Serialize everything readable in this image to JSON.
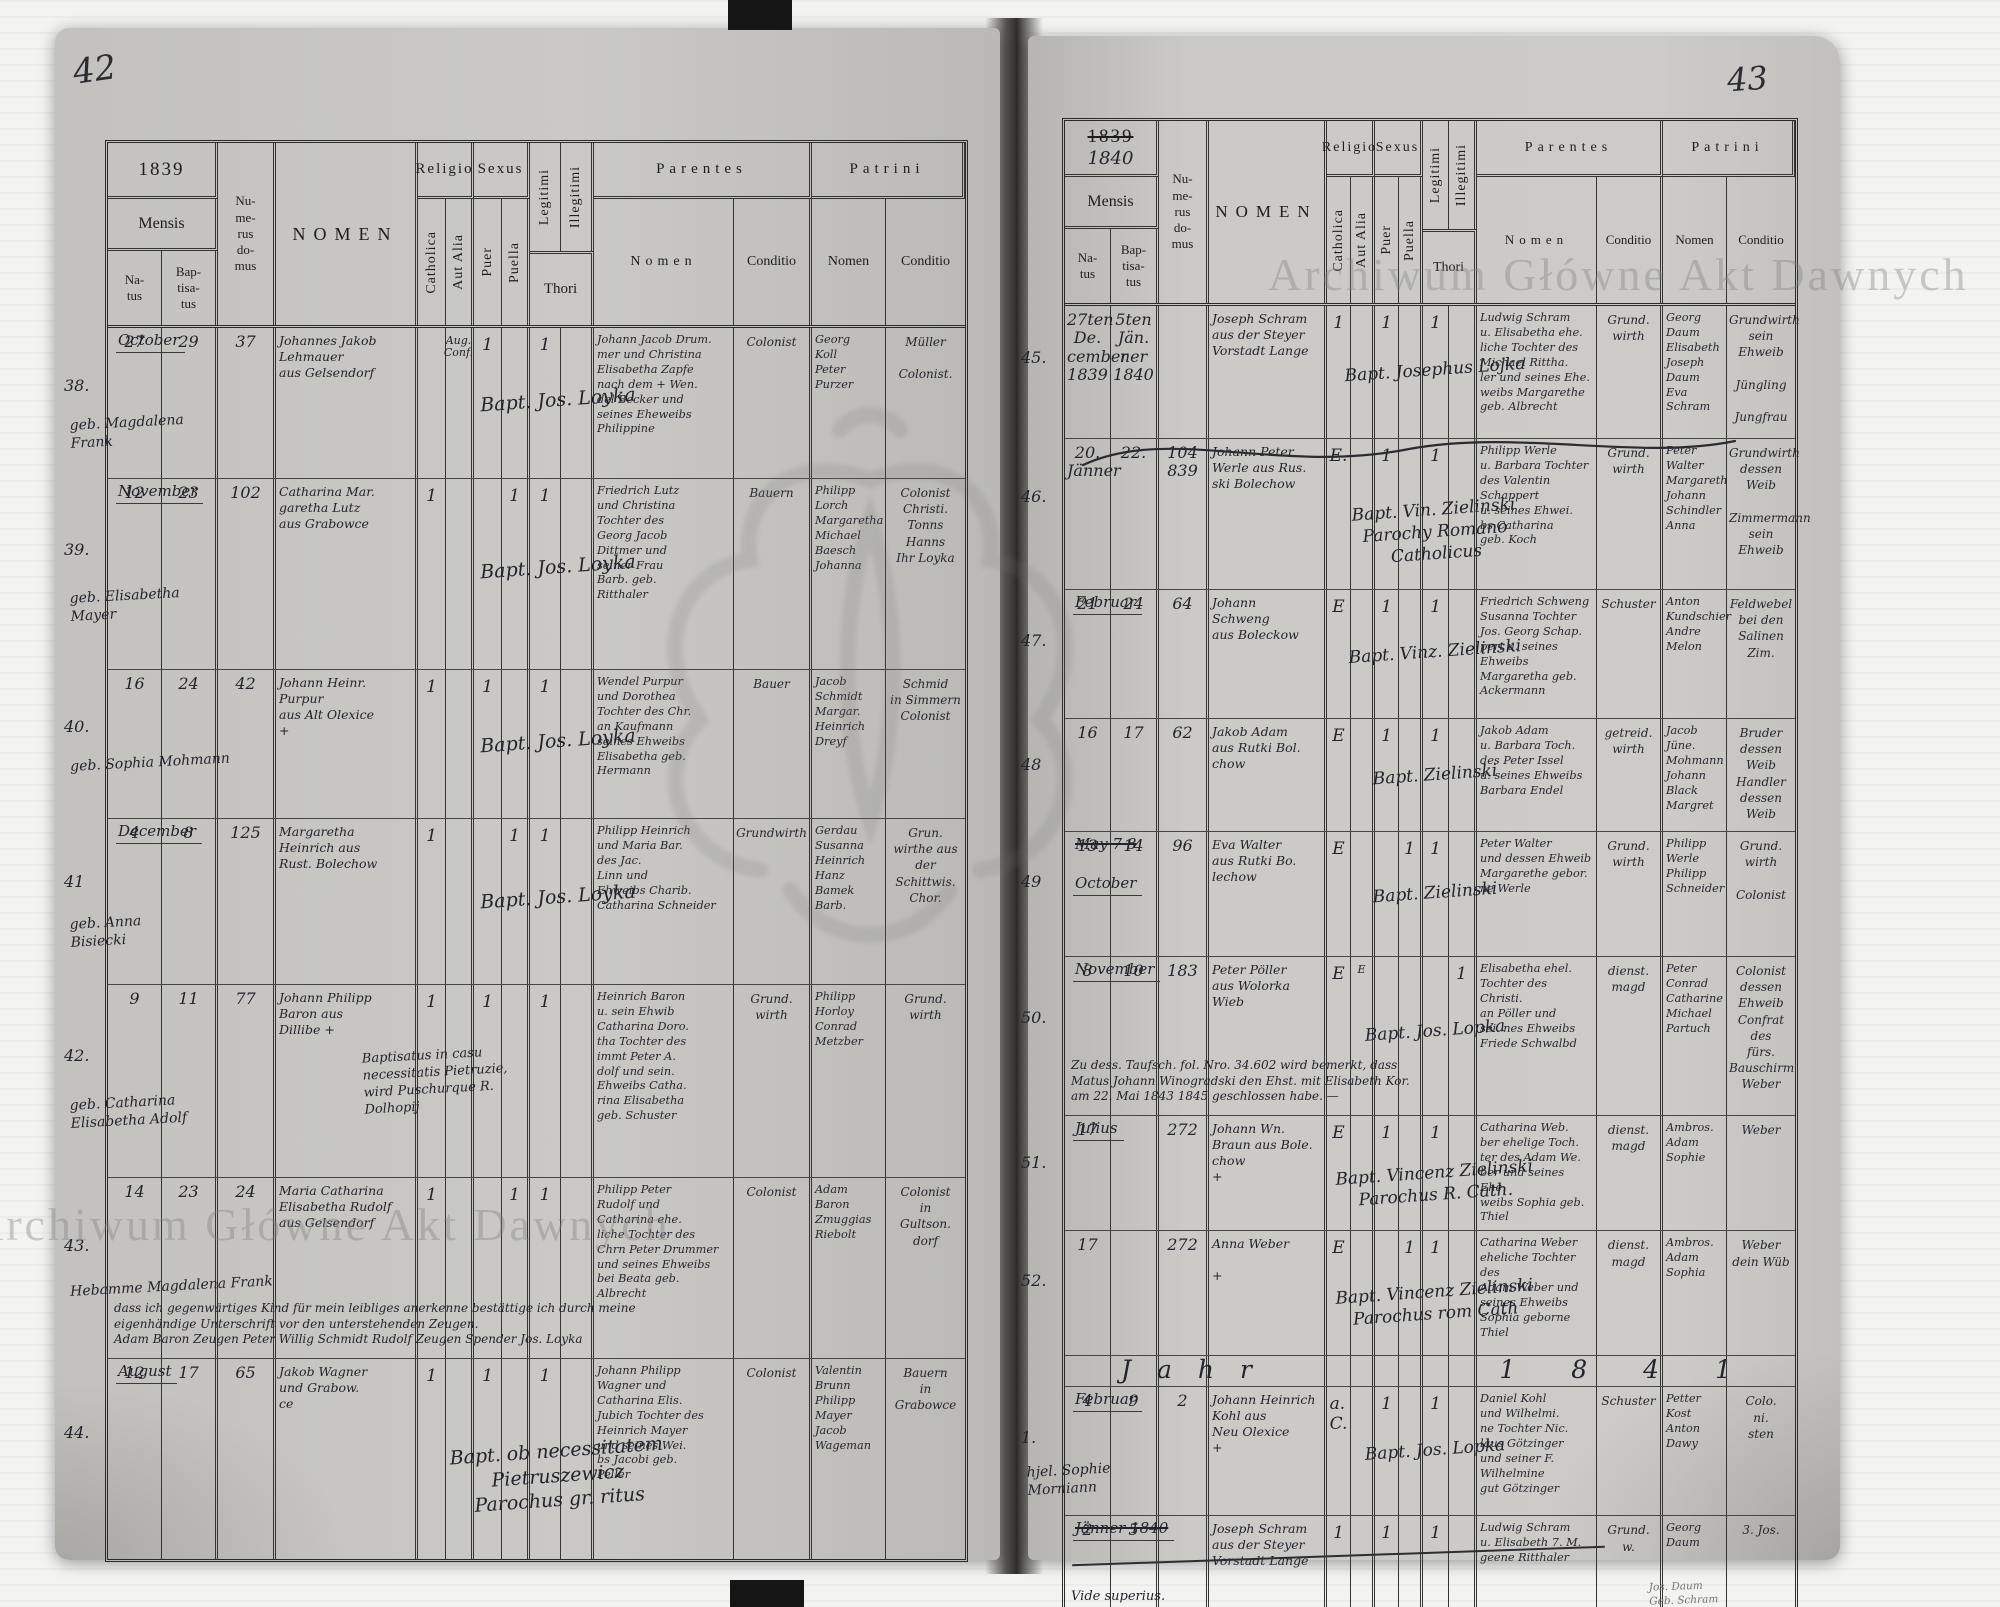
{
  "document": {
    "watermark": "Archiwum Główne Akt Dawnych",
    "left_page_number": "42",
    "right_page_number": "43"
  },
  "hdr": {
    "year_left": "1839",
    "year_right_old": "1839",
    "year_right_new": "1840",
    "mensis": "Mensis",
    "natus": "Na-\ntus",
    "bapt": "Bap-\ntisa-\ntus",
    "numerus": "Nu-\nme-\nrus\ndo-\nmus",
    "nomen": "NOMEN",
    "religio": "Religio",
    "catholica": "Catholica",
    "aut_alia": "Aut Alia",
    "sexus": "Sexus",
    "puer": "Puer",
    "puella": "Puella",
    "legitimi": "Legitimi",
    "illegitimi": "Illegitimi",
    "thori": "Thori",
    "parentes": "Parentes",
    "patrini": "Patrini",
    "nomen_sub": "Nomen",
    "conditio": "Conditio"
  },
  "left": {
    "entries": [
      {
        "no": "38.",
        "month": "October",
        "natus": "27",
        "bapt": "29",
        "house": "37",
        "name": "Johannes Jakob\nLehmauer\naus Gelsendorf",
        "name2": "geb. Magdalena\nFrank",
        "relig_alia": "Aug.\nConf.",
        "m_puer": "1",
        "m_legit": "1",
        "sacr": "Bapt. Jos. Loyka",
        "par": "Johann Jacob Drum.\nmer und Christina\nElisabetha Zapfe\nnach dem + Wen.\ndel Becker und\nseines Eheweibs\nPhilippine",
        "par_c": "Colonist",
        "pat": "Georg\nKoll\nPeter\nPurzer",
        "pat_c": "Müller\n\nColonist."
      },
      {
        "no": "39.",
        "month": "November",
        "natus": "12",
        "bapt": "23",
        "house": "102",
        "name": "Catharina Mar.\ngaretha Lutz\naus Grabowce",
        "name2": "geb. Elisabetha\nMayer",
        "relig_cath": "1",
        "m_puella": "1",
        "m_legit": "1",
        "sacr": "Bapt. Jos. Loyka",
        "par": "Friedrich Lutz\nund Christina\nTochter des\nGeorg Jacob\nDittmer und\nseiner Frau\nBarb. geb.\nRitthaler",
        "par_c": "Bauern",
        "pat": "Philipp\nLorch\nMargaretha\nMichael\nBaesch\nJohanna",
        "pat_c": "Colonist\nChristi.\nTonns\nHanns\nIhr Loyka"
      },
      {
        "no": "40.",
        "natus": "16",
        "bapt": "24",
        "house": "42",
        "name": "Johann Heinr.\nPurpur\naus Alt Olexice\n+",
        "name2": "geb. Sophia Mohmann",
        "relig_cath": "1",
        "m_puer": "1",
        "m_legit": "1",
        "sacr": "Bapt. Jos. Loyka",
        "par": "Wendel Purpur\nund Dorothea\nTochter des Chr.\nan Kaufmann\nseines Ehweibs\nElisabetha geb.\nHermann",
        "par_c": "Bauer",
        "pat": "Jacob\nSchmidt\nMargar.\nHeinrich\nDreyf",
        "pat_c": "Schmid\nin Simmern\nColonist"
      },
      {
        "no": "41",
        "month": "December",
        "natus": "4",
        "bapt": "8",
        "house": "125",
        "name": "Margaretha\nHeinrich aus\nRust. Bolechow",
        "name2": "geb. Anna\nBisiecki",
        "relig_cath": "1",
        "m_puella": "1",
        "m_legit": "1",
        "sacr": "Bapt. Jos. Loyka",
        "par": "Philipp Heinrich\nund Maria Bar.\ndes Jac.\nLinn und\nEhweibs Charib.\nCatharina Schneider",
        "par_c": "Grundwirth",
        "pat": "Gerdau\nSusanna\nHeinrich\nHanz\nBamek\nBarb.",
        "pat_c": "Grun.\nwirthe aus\nder Schittwis.\nChor."
      },
      {
        "no": "42.",
        "natus": "9",
        "bapt": "11",
        "house": "77",
        "name": "Johann Philipp\nBaron aus\nDillibe  +",
        "name2": "geb. Catharina\nElisabetha Adolf",
        "note": "Baptisatus in casu\nnecessitatis Pietruzie,\nwird Puschurque R.\nDolhopij",
        "relig_cath": "1",
        "m_puer": "1",
        "m_legit": "1",
        "par": "Heinrich Baron\nu. sein Ehwib\nCatharina Doro.\ntha Tochter des\nimmt Peter A.\ndolf und sein.\nEhweibs Catha.\nrina Elisabetha\ngeb. Schuster",
        "par_c": "Grund.\nwirth",
        "pat": "Philipp\nHorloy\nConrad\nMetzber",
        "pat_c": "Grund.\nwirth"
      },
      {
        "no": "43.",
        "natus": "14",
        "bapt": "23",
        "house": "24",
        "name": "Maria Catharina\nElisabetha Rudolf\naus Gelsendorf",
        "name2": "Hebamme Magdalena Frank",
        "note2": "dass ich gegenwärtiges Kind für mein leibliges anerkenne bestättige ich durch meine\neigenhändige Unterschrift vor den unterstehenden Zeugen.\nAdam Baron   Zeugen      Peter Willig   Schmidt      Rudolf      Zeugen Spender      Jos. Loyka",
        "relig_cath": "1",
        "m_puella": "1",
        "m_legit": "1",
        "par": "Philipp Peter\nRudolf und\nCatharina ehe.\nliche Tochter des\nChrn Peter Drummer\nund seines Ehweibs\nbei Beata geb.\nAlbrecht",
        "par_c": "Colonist",
        "pat": "Adam\nBaron\nZmuggias\nRiebolt",
        "pat_c": "Colonist\nin\nGultson.\ndorf"
      },
      {
        "no": "44.",
        "month": "August",
        "natus": "12",
        "bapt": "17",
        "house": "65",
        "name": "Jakob Wagner\nund Grabow.\nce",
        "relig_cath": "1",
        "m_puer": "1",
        "m_legit": "1",
        "sacr": "Bapt. ob necessitatem\nPietruszewicz\nParochus gr. ritus",
        "par": "Johann Philipp\nWagner und\nCatharina Elis.\nJubich Tochter des\nHeinrich Mayer\nund seines Wei.\nbs Jacobi geb.\nPeller",
        "par_c": "Colonist",
        "pat": "Valentin\nBrunn\nPhilipp\nMayer\nJacob\nWageman",
        "pat_c": "Bauern\nin\nGrabowce"
      }
    ]
  },
  "right": {
    "entries": [
      {
        "no": "45.",
        "natus": "27ten\nDe.\ncember\n1839",
        "bapt": "5ten\nJän.\nner\n1840",
        "name": "Joseph Schram\naus der Steyer\nVorstadt Lange",
        "sacr": "Bapt. Josephus Lojka",
        "relig_cath": "1",
        "m_puer": "1",
        "m_legit": "1",
        "par": "Ludwig Schram\nu. Elisabetha ehe.\nliche Tochter des\nMichael Rittha.\nler und seines Ehe.\nweibs Margarethe\ngeb. Albrecht",
        "par_c": "Grund.\nwirth",
        "pat": "Georg\nDaum\nElisabeth\nJoseph\nDaum\nEva\nSchram",
        "pat_c": "Grundwirth\nsein Ehweib\n\nJüngling\n\nJungfrau"
      },
      {
        "no": "46.",
        "flourish": true,
        "natus": "20.\nJänner",
        "bapt": "22.",
        "house": "104\n839",
        "name": "Johann Peter\nWerle aus Rus.\nski Bolechow",
        "sacr": "Bapt. Vin. Zielinski\nParochy Romano\nCatholicus",
        "relig_cath": "E.",
        "m_puer": "1",
        "m_legit": "1",
        "par": "Philipp Werle\nu. Barbara Tochter\ndes Valentin\nSchappert\nu. seines Ehwei.\nbs Catharina\ngeb. Koch",
        "par_c": "Grund.\nwirth",
        "pat": "Peter\nWalter\nMargareth\nJohann\nSchindler\nAnna",
        "pat_c": "Grundwirth\ndessen Weib\n\nZimmermann\nsein Ehweib"
      },
      {
        "no": "47.",
        "month": "Februar",
        "natus": "21",
        "bapt": "24",
        "house": "64",
        "name": "Johann\nSchweng\naus Boleckow",
        "sacr": "Bapt. Vinz. Zielinski",
        "relig_cath": "E",
        "m_puer": "1",
        "m_legit": "1",
        "par": "Friedrich Schweng\nSusanna Tochter\nJos. Georg Schap.\npert u. seines Ehweibs\nMargaretha geb.\nAckermann",
        "par_c": "Schuster",
        "pat": "Anton\nKundschier\nAndre\nMelon",
        "pat_c": "Feldwebel\nbei den\nSalinen Zim."
      },
      {
        "no": "48",
        "natus": "16",
        "bapt": "17",
        "house": "62",
        "name": "Jakob Adam\naus Rutki Bol.\nchow",
        "sacr": "Bapt. Zielinski",
        "relig_cath": "E",
        "m_puer": "1",
        "m_legit": "1",
        "par": "Jakob Adam\nu. Barbara Toch.\ndes Peter Issel\nu. seines Ehweibs\nBarbara Endel",
        "par_c": "getreid.\nwirth",
        "pat": "Jacob Jüne.\nMohmann\nJohann\nBlack\nMargret",
        "pat_c": "Bruder\ndessen Weib\nHandler\ndessen Weib"
      },
      {
        "no": "49",
        "month_old": "May  7  8",
        "month": "October",
        "natus": "13",
        "bapt": "14",
        "house": "96",
        "name": "Eva Walter\naus Rutki Bo.\nlechow",
        "sacr": "Bapt. Zielinski",
        "relig_cath": "E",
        "m_puella": "1",
        "m_legit": "1",
        "par": "Peter Walter\nund dessen Ehweib\nMargarethe gebor.\nne Werle",
        "par_c": "Grund.\nwirth",
        "pat": "Philipp\nWerle\nPhilipp\nSchneider",
        "pat_c": "Grund.\nwirth\n\nColonist"
      },
      {
        "no": "50.",
        "month": "November",
        "natus": "8",
        "bapt": "10",
        "house": "183",
        "name": "Peter Pöller\naus Wolorka\nWieb",
        "sacr": "Bapt. Jos. Lopka",
        "note2": "Zu dess. Taufsch. fol. Nro. 34.602 wird bemerkt, dass\nMatus Johann Winogradski den Ehst. mit Elisabeth Kor.\nam 22. Mai 1843 1845 geschlossen habe. —",
        "relig_cath": "E",
        "relig_alia": "E",
        "m_illeg": "1",
        "par": "Elisabetha ehel.\nTochter des Christi.\nan Pöller und\nsei. nes Ehweibs\nFriede Schwalbd",
        "par_c": "dienst.\nmagd",
        "pat": "Peter\nConrad\nCatharine\nMichael\nPartuch",
        "pat_c": "Colonist\ndessen Ehweib\nConfrat des\nfürs. Bauschirm\nWeber"
      },
      {
        "no": "51.",
        "month": "Julius",
        "natus": "17",
        "house": "272",
        "name": "Johann Wn.\nBraun aus Bole.\nchow\n+",
        "sacr": "Bapt. Vincenz Zielinski\nParochus R. Cath.",
        "relig_cath": "E",
        "m_puer": "1",
        "m_legit": "1",
        "par": "Catharina Web.\nber ehelige Toch.\nter des Adam We.\nber und seines Ehe.\nweibs Sophia geb.\nThiel",
        "par_c": "dienst.\nmagd",
        "pat": "Ambros.\nAdam\nSophie",
        "pat_c": "Weber"
      },
      {
        "no": "52.",
        "natus": "17",
        "house": "272",
        "name": "Anna Weber\n\n+",
        "sacr": "Bapt. Vincenz Zielinski\nParochus rom Cath",
        "relig_cath": "E",
        "m_puella": "1",
        "m_legit": "1",
        "par": "Catharina Weber\neheliche Tochter des\nAdam Weber und\nseines Ehweibs\nSophia geborne\nThiel",
        "par_c": "dienst.\nmagd",
        "pat": "Ambros.\nAdam\nSophia",
        "pat_c": "Weber\ndein Wüb"
      },
      {
        "divider_label": "Jahr",
        "divider_year": "1841"
      },
      {
        "no": "1.",
        "month": "Februar",
        "natus": "4",
        "bapt": "9",
        "house": "2",
        "name": "Johann Heinrich\nKohl aus\nNeu Olexice\n+",
        "name2": "hjel. Sophie\nMorniann",
        "sacr": "Bapt. Jos. Lopka",
        "relig_cath": "a.\nC.",
        "m_puer": "1",
        "m_legit": "1",
        "par": "Daniel Kohl\nund Wilhelmi.\nne Tochter Nic.\nlaus Götzinger\nund seiner F.\nWilhelmine\ngut Götzinger",
        "par_c": "Schuster",
        "pat": "Petter\nKost\nAnton\nDawy",
        "pat_c": "Colo.\nni.\nsten"
      },
      {
        "type": "crossed",
        "month_old": "Jänner 1840",
        "natus": "2",
        "bapt": "5",
        "name": "Joseph Schram\naus der Steyer\nVorstadt Lange",
        "vide": "Vide superius.",
        "relig_cath": "1",
        "m_puer": "1",
        "m_legit": "1",
        "par": "Ludwig Schram\nu. Elisabeth 7. M.\ngeene Ritthaler",
        "par_c": "Grund.\nw.",
        "pat": "Georg\nDaum",
        "pat_c": "3. Jos.",
        "pencil": "Jos. Daum\nGeb. Schram"
      }
    ]
  }
}
